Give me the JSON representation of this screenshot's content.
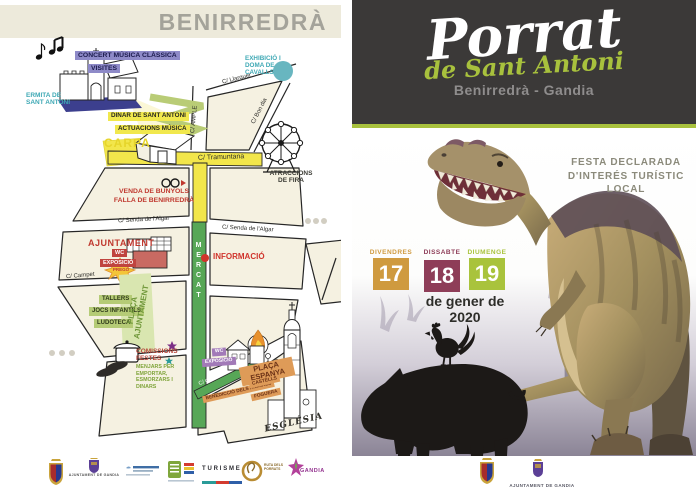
{
  "left_page": {
    "title": "BENIRREDRÀ",
    "map": {
      "labels": {
        "concert": "CONCERT MÚSICA CLÀSSICA",
        "visites": "VISITES",
        "ermita": "ERMITA DE SANT ANTONI",
        "exhibicio": "EXHIBICIÓ I DOMA DE CAVALLS",
        "dinar": "DINAR DE SANT ANTONI",
        "actuacions": "ACTUACIONS MÚSICA",
        "carpa": "CARPA",
        "atraccions": "ATRACCIONS DE FIRA",
        "venda_bunyols": "VENDA DE BUNYOLS",
        "falla": "FALLA DE BENIRREDRÀ",
        "ajuntament": "AJUNTAMENT",
        "wc_1": "WC",
        "exposicio_1": "EXPOSICIÓ",
        "informacio": "INFORMACIÓ",
        "prego": "PREGÓ",
        "tallers": "TALLERS",
        "jocs_infantils": "JOCS INFANTILS",
        "ludoteca": "LUDOTECA",
        "placa_ajuntament": "PLAÇA AJUNTAMENT",
        "mercat": "MERCAT",
        "comissions": "COMISSIONS FESTES",
        "menjars": "MENJARS PER EMPORTAR, ESMORZARS I DINARS",
        "wc_2": "WC",
        "exposicio_2": "EXPOSICIÓ",
        "placa_espanya": "PLAÇA ESPANYA",
        "benediccio": "BENEDICCIÓ DELS ANIMALS",
        "castells": "CASTELLS",
        "foguera": "FOGUERA",
        "esglesia": "ESGLÉSIA"
      },
      "streets": {
        "llarguer": "C/ Llarguer",
        "ample": "C/ AMPLE",
        "bon_dia": "C/ Bon dia",
        "tramuntana": "C/ Tramuntana",
        "senda_algar_left": "C/ Senda de l'Algar",
        "senda_algar_right": "C/ Senda de l'Algar",
        "campet": "C/ Campet",
        "del_ram": "C/ del Ram"
      }
    },
    "sponsors": {
      "ajuntament_gandia": "AJUNTAMENT DE GANDIA",
      "turisme": "TURISME",
      "ruta_porrats": "RUTA DELS PORRATS",
      "gandia": "GANDIA"
    }
  },
  "right_page": {
    "header": {
      "title": "Porrat",
      "subtitle": "de Sant Antoni",
      "location": "Benirredrà - Gandia"
    },
    "festa_note": "FESTA DECLARADA D'INTERÉS TURÍSTIC LOCAL",
    "dates": [
      {
        "day_name": "DIVENDRES",
        "day": "17",
        "color": "#cf9a3f"
      },
      {
        "day_name": "DISSABTE",
        "day": "18",
        "color": "#8e3d58"
      },
      {
        "day_name": "DIUMENGE",
        "day": "19",
        "color": "#a9c33c"
      }
    ],
    "month_line": "de gener de 2020",
    "footer": {
      "council": "AJUNTAMENT DE GANDIA"
    }
  },
  "colors": {
    "accent_green": "#a8c13d",
    "header_dark": "#3b3938",
    "band_beige": "#edeadb",
    "street_yellow": "#f2e64b",
    "street_green": "#57a757",
    "badge_purple": "#8e8ac8",
    "badge_red": "#c0443f",
    "badge_orange": "#de9b58",
    "teal": "#3fa9b5",
    "date_orange": "#cf9a3f",
    "date_maroon": "#8e3d58",
    "date_green": "#a9c33c"
  }
}
